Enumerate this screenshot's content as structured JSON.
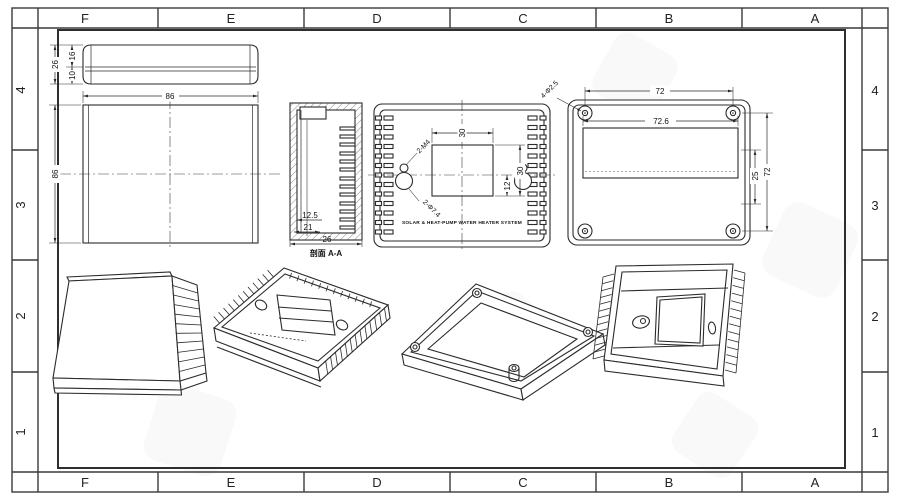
{
  "border": {
    "cols": [
      "F",
      "E",
      "D",
      "C",
      "B",
      "A"
    ],
    "rows": [
      "4",
      "3",
      "2",
      "1"
    ]
  },
  "colors": {
    "line": "#2b2b2b",
    "background": "#ffffff"
  },
  "view_cover": {
    "dim_total": "26",
    "dim_upper": "16",
    "dim_lower": "10",
    "dim_width": "86",
    "dim_height": "86"
  },
  "view_section": {
    "dim_inner": "12.5",
    "dim_mid": "21",
    "dim_overall": "26",
    "label": "剖面 A-A"
  },
  "view_front": {
    "dim_window_w": "30",
    "dim_window_h": "30",
    "dim_center": "12",
    "callout_screws": "2-M4",
    "callout_holes": "2-Φ7.4",
    "brand": "SOLAR & HEAT-PUMP WATER HEATER SYSTEM"
  },
  "view_back": {
    "dim_holes_h": "72",
    "dim_window_w": "72.6",
    "dim_window_h": "25",
    "dim_holes_v": "72",
    "callout_holes": "4-Φ2.5"
  }
}
